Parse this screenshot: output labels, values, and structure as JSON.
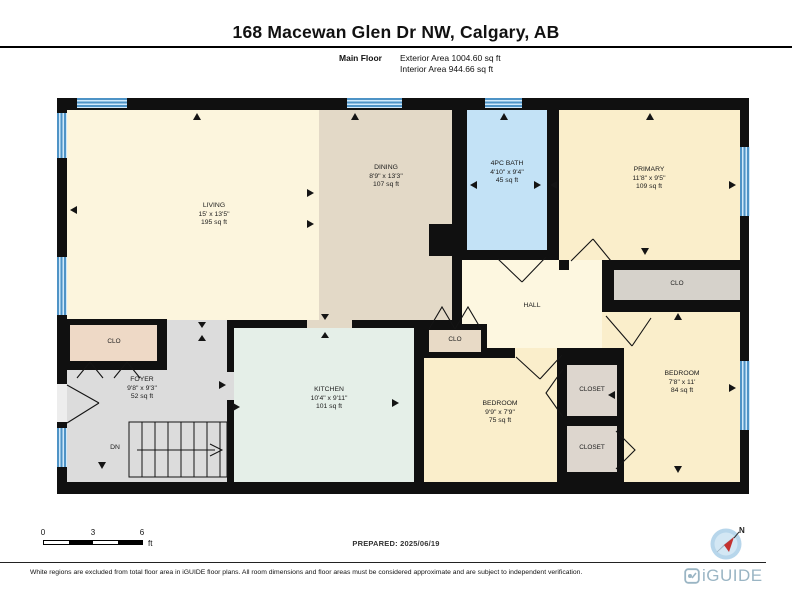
{
  "header": {
    "title": "168 Macewan Glen Dr NW, Calgary, AB",
    "floor_label": "Main Floor",
    "exterior_area": "Exterior Area 1004.60 sq ft",
    "interior_area": "Interior Area 944.66 sq ft"
  },
  "rooms": [
    {
      "name": "LIVING",
      "dims": "15' x 13'5\"",
      "area": "195 sq ft"
    },
    {
      "name": "DINING",
      "dims": "8'9\" x 13'3\"",
      "area": "107 sq ft"
    },
    {
      "name": "4PC BATH",
      "dims": "4'10\" x 9'4\"",
      "area": "45 sq ft"
    },
    {
      "name": "PRIMARY",
      "dims": "11'8\" x 9'5\"",
      "area": "109 sq ft"
    },
    {
      "name": "HALL"
    },
    {
      "name": "CLO"
    },
    {
      "name": "CLO"
    },
    {
      "name": "FOYER",
      "dims": "9'8\" x 9'3\"",
      "area": "52 sq ft"
    },
    {
      "name": "KITCHEN",
      "dims": "10'4\" x 9'11\"",
      "area": "101 sq ft"
    },
    {
      "name": "BEDROOM",
      "dims": "9'9\" x 7'9\"",
      "area": "75 sq ft"
    },
    {
      "name": "CLOSET"
    },
    {
      "name": "CLOSET"
    },
    {
      "name": "BEDROOM",
      "dims": "7'8\" x 11'",
      "area": "84 sq ft"
    },
    {
      "name": "CLO"
    }
  ],
  "stairs": {
    "label": "DN"
  },
  "compass": {
    "north_label": "N"
  },
  "scale_bar": {
    "ticks": [
      "0",
      "3",
      "6"
    ],
    "unit": "ft"
  },
  "footer": {
    "prepared": "PREPARED: 2025/06/19",
    "disclaimer": "White regions are excluded from total floor area in iGUIDE floor plans. All room dimensions and floor areas must be considered approximate and are subject to independent verification.",
    "logo_text": "iGUIDE"
  },
  "colors": {
    "wall": "#101010",
    "living": "#fcf5dd",
    "dining": "#e3d9c7",
    "bath": "#c3e2f6",
    "bedroom": "#faeecb",
    "hall": "#fdf7e0",
    "kitchen": "#e5efe8",
    "foyer": "#dcdcdc",
    "closet_tan": "#eed9c6",
    "closet_gray": "#ddd6ce",
    "window_fill": "#cfe8fa",
    "window_frame": "#4e93c6",
    "logo_blue": "#9ab5c4",
    "compass_red": "#c4312f"
  }
}
